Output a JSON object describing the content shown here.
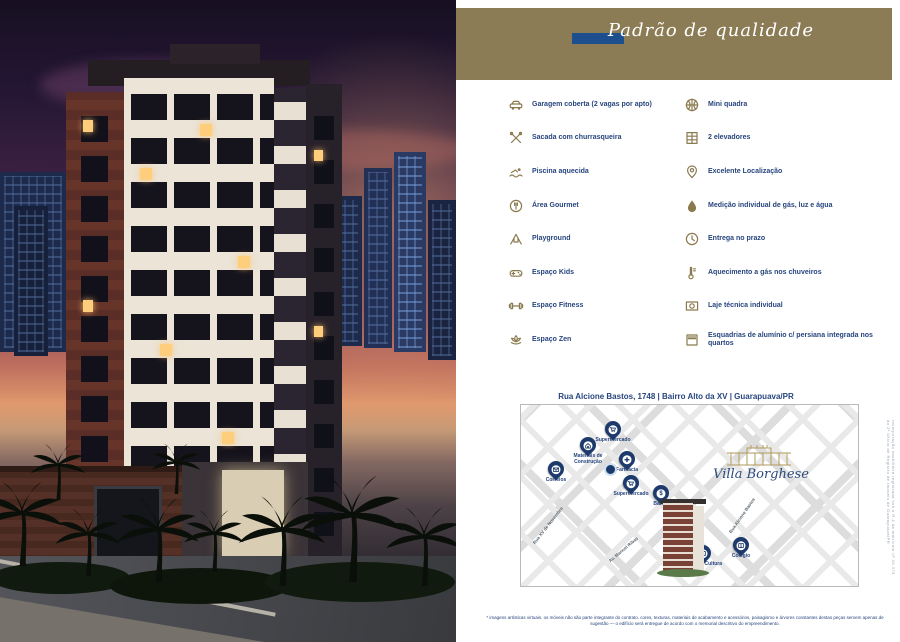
{
  "header": {
    "title": "Padrão de qualidade"
  },
  "amenities": {
    "left": [
      {
        "icon": "car-icon",
        "label": "Garagem coberta (2 vagas por apto)"
      },
      {
        "icon": "bbq-icon",
        "label": "Sacada com churrasqueira"
      },
      {
        "icon": "swimmer-icon",
        "label": "Piscina aquecida"
      },
      {
        "icon": "gourmet-icon",
        "label": "Área Gourmet"
      },
      {
        "icon": "playground-icon",
        "label": "Playground"
      },
      {
        "icon": "gamepad-icon",
        "label": "Espaço Kids"
      },
      {
        "icon": "dumbbell-icon",
        "label": "Espaço Fitness"
      },
      {
        "icon": "lotus-icon",
        "label": "Espaço Zen"
      }
    ],
    "right": [
      {
        "icon": "basketball-icon",
        "label": "Mini quadra"
      },
      {
        "icon": "elevator-icon",
        "label": "2 elevadores"
      },
      {
        "icon": "map-pin-icon",
        "label": "Excelente Localização"
      },
      {
        "icon": "water-drop-icon",
        "label": "Medição individual de gás, luz e água"
      },
      {
        "icon": "clock-icon",
        "label": "Entrega no prazo"
      },
      {
        "icon": "thermometer-icon",
        "label": "Aquecimento a gás nos chuveiros"
      },
      {
        "icon": "slab-icon",
        "label": "Laje técnica individual"
      },
      {
        "icon": "window-icon",
        "label": "Esquadrias de alumínio c/ persiana integrada nos quartos"
      }
    ]
  },
  "location": {
    "address": "Rua Alcione Bastos, 1748 | Bairro Alto da XV | Guarapuava/PR"
  },
  "map": {
    "brand": "Villa Borghese",
    "pois": [
      {
        "icon": "cart-icon",
        "label": "Supermercado"
      },
      {
        "icon": "house-icon",
        "label": "Materiais de Construção"
      },
      {
        "icon": "pharmacy-cross-icon",
        "label": "Farmácia"
      },
      {
        "icon": "envelope-icon",
        "label": "Correios"
      },
      {
        "icon": "cart-icon",
        "label": "Supermercado"
      },
      {
        "icon": "dollar-icon",
        "label": "Banco",
        "glyph": "$"
      },
      {
        "icon": "book-icon",
        "label": "Casa de Cultura"
      },
      {
        "icon": "book-icon",
        "label": "Colégio"
      }
    ],
    "streets": [
      {
        "label": "Rua XV de Novembro"
      },
      {
        "label": "Av. Manoel Ribas"
      },
      {
        "label": "Rua Alcione Bastos"
      }
    ]
  },
  "footer": {
    "disclaimer": "* imagens artísticas virtuais. os móveis não são parte integrante do contrato. cores, texturas, materiais de acabamento e acessórios, paisagismo e árvores constantes destas peças servem apenas de sugestão — o edifício será entregue de acordo com o memorial descritivo do empreendimento.",
    "registry_note": "Incorporação imobiliária registrada sob o R.4 da matrícula nº 43.375 do 2º Ofício de Registro de Imóveis de Guarapuava/PR"
  },
  "colors": {
    "olive": "#8b7c55",
    "navy_text": "#27457e",
    "bar_blue": "#1d4f8f",
    "icon_olive": "#8b7a4f",
    "pin_navy": "#1d3a6c",
    "script_blue": "#2b4a7d",
    "gold": "#b29a5c"
  }
}
